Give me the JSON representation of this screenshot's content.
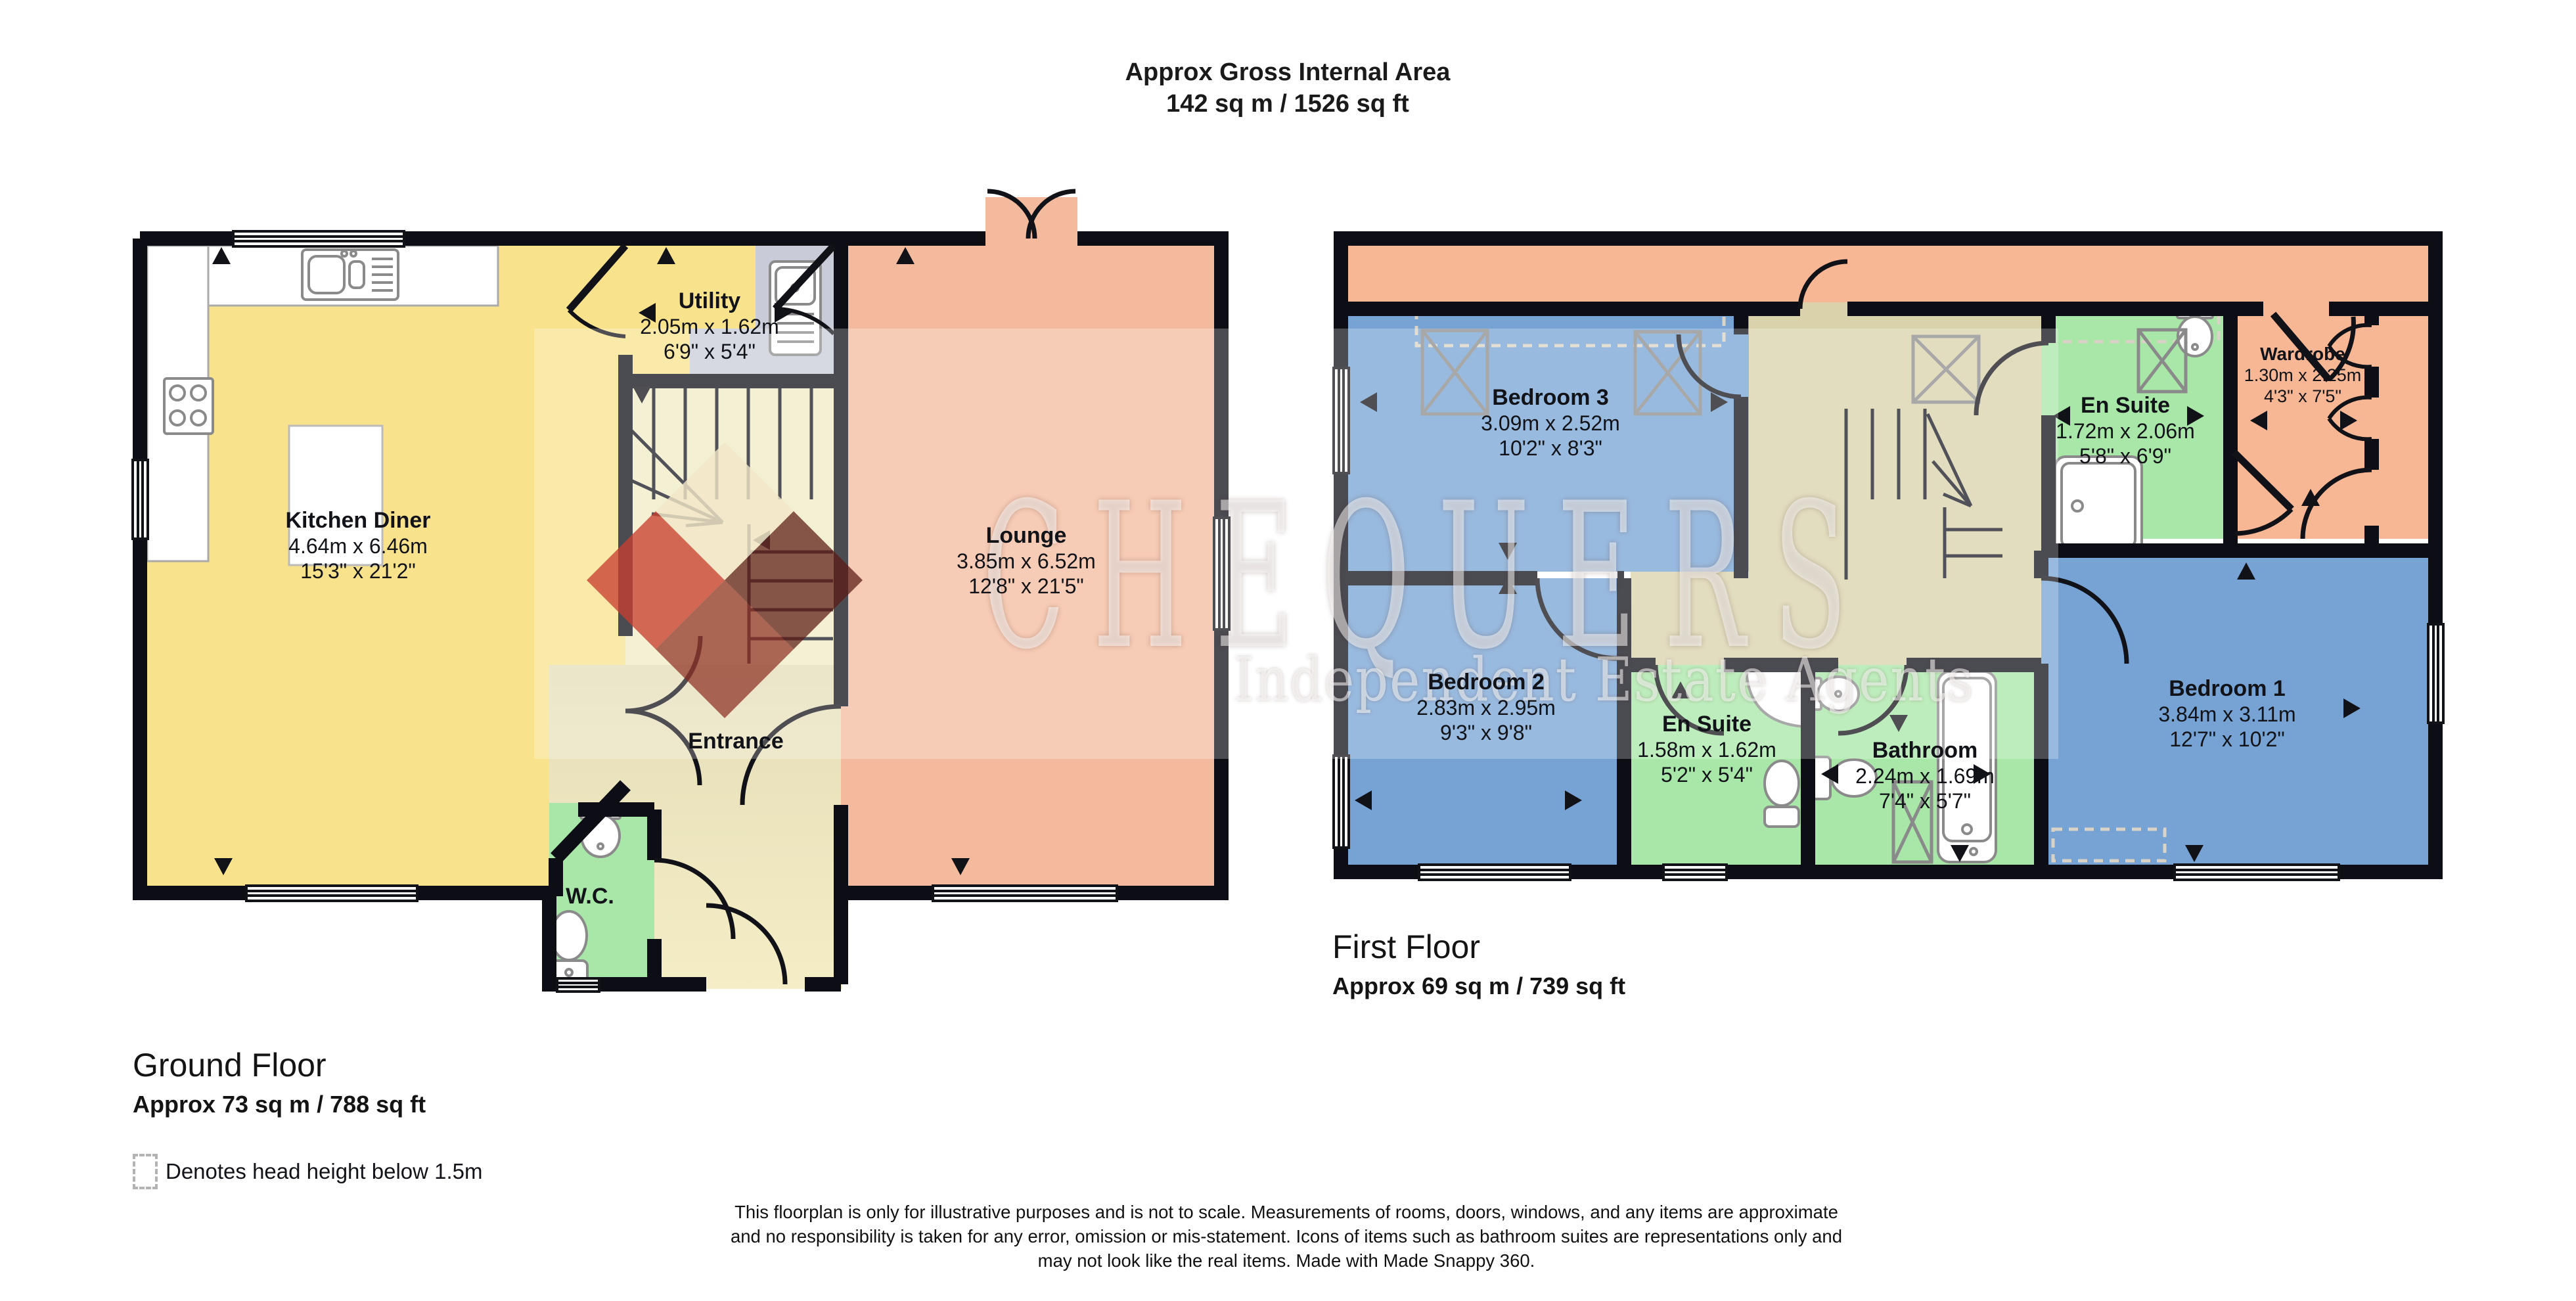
{
  "header": {
    "line1": "Approx Gross Internal Area",
    "line2": "142 sq m / 1526 sq ft"
  },
  "watermark": {
    "brand": "CHEQUERS",
    "tagline": "Independent Estate Agents"
  },
  "ground_floor": {
    "title": "Ground Floor",
    "area": "Approx 73 sq m / 788 sq ft",
    "rooms": {
      "kitchen": {
        "name": "Kitchen Diner",
        "metric": "4.64m x 6.46m",
        "imperial": "15'3\" x 21'2\""
      },
      "utility": {
        "name": "Utility",
        "metric": "2.05m x 1.62m",
        "imperial": "6'9\" x 5'4\""
      },
      "lounge": {
        "name": "Lounge",
        "metric": "3.85m x 6.52m",
        "imperial": "12'8\" x 21'5\""
      },
      "entrance": {
        "name": "Entrance"
      },
      "wc": {
        "name": "W.C."
      }
    }
  },
  "first_floor": {
    "title": "First Floor",
    "area": "Approx 69 sq m / 739 sq ft",
    "rooms": {
      "bedroom3": {
        "name": "Bedroom 3",
        "metric": "3.09m x 2.52m",
        "imperial": "10'2\" x 8'3\""
      },
      "ensuite_top": {
        "name": "En Suite",
        "metric": "1.72m x 2.06m",
        "imperial": "5'8\" x 6'9\""
      },
      "wardrobe": {
        "name": "Wardrobe",
        "metric": "1.30m x 2.25m",
        "imperial": "4'3\" x 7'5\""
      },
      "bedroom2": {
        "name": "Bedroom 2",
        "metric": "2.83m x 2.95m",
        "imperial": "9'3\" x 9'8\""
      },
      "ensuite_bottom": {
        "name": "En Suite",
        "metric": "1.58m x 1.62m",
        "imperial": "5'2\" x 5'4\""
      },
      "bathroom": {
        "name": "Bathroom",
        "metric": "2.24m x 1.69m",
        "imperial": "7'4\" x 5'7\""
      },
      "bedroom1": {
        "name": "Bedroom 1",
        "metric": "3.84m x 3.11m",
        "imperial": "12'7\" x 10'2\""
      }
    }
  },
  "legend": {
    "label": "Denotes head height below 1.5m"
  },
  "disclaimer": {
    "line1": "This floorplan is only for illustrative purposes and is not to scale. Measurements of rooms, doors, windows, and any items are approximate",
    "line2": "and no responsibility is taken for any error, omission or mis-statement. Icons of items such as bathroom suites are representations only and",
    "line3": "may not look like the real items. Made with Made Snappy 360."
  },
  "colors": {
    "kitchen_yellow": "#F8E38C",
    "hall_beige": "#D6CFAC",
    "hall_cream": "#F4EDC5",
    "stairs_cream": "#F1EBC4",
    "lounge_salmon": "#F4BA9D",
    "wc_green": "#A8E7A7",
    "bedroom_blue": "#76A3D4",
    "landing_beige": "#D9D2AB",
    "eaves_salmon": "#F7B795",
    "counter_gray": "#C9CCD8",
    "wall_black": "#0D0D16",
    "fixture_gray": "#8A8A8A",
    "watermark_red": "#C84030",
    "watermark_dark": "#5A1912"
  }
}
